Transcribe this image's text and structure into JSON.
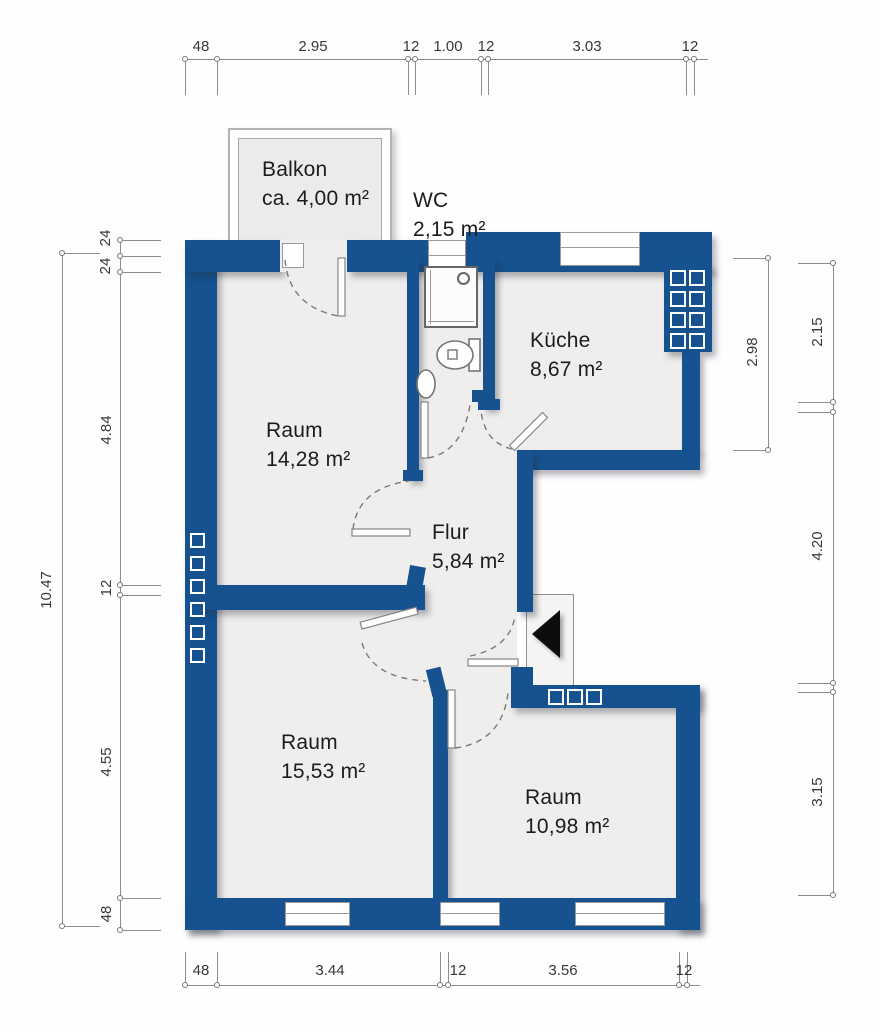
{
  "rooms": {
    "balkon": {
      "name": "Balkon",
      "area": "ca. 4,00 m²"
    },
    "wc": {
      "name": "WC",
      "area": "2,15 m²"
    },
    "kueche": {
      "name": "Küche",
      "area": "8,67 m²"
    },
    "raum1": {
      "name": "Raum",
      "area": "14,28 m²"
    },
    "flur": {
      "name": "Flur",
      "area": "5,84 m²"
    },
    "raum2": {
      "name": "Raum",
      "area": "15,53 m²"
    },
    "raum3": {
      "name": "Raum",
      "area": "10,98 m²"
    }
  },
  "dimensions": {
    "top": [
      "48",
      "2.95",
      "12",
      "1.00",
      "12",
      "3.03",
      "12"
    ],
    "bottom": [
      "48",
      "3.44",
      "12",
      "3.56",
      "12"
    ],
    "left_inner": [
      "24",
      "24",
      "4.84",
      "12",
      "4.55",
      "48"
    ],
    "left_outer": [
      "10.47"
    ],
    "right_inner": [
      "2.98"
    ],
    "right_outer": [
      "2.15",
      "4.20",
      "3.15"
    ]
  },
  "colors": {
    "wall_blue": "#15528f",
    "floor_gray": "#efeeec",
    "dimension_gray": "#8d8d8d",
    "entrance_arrow": "#0d0d0d"
  },
  "icons": {
    "entrance": "entrance-arrow",
    "bath": [
      "shower",
      "toilet",
      "sink"
    ]
  }
}
